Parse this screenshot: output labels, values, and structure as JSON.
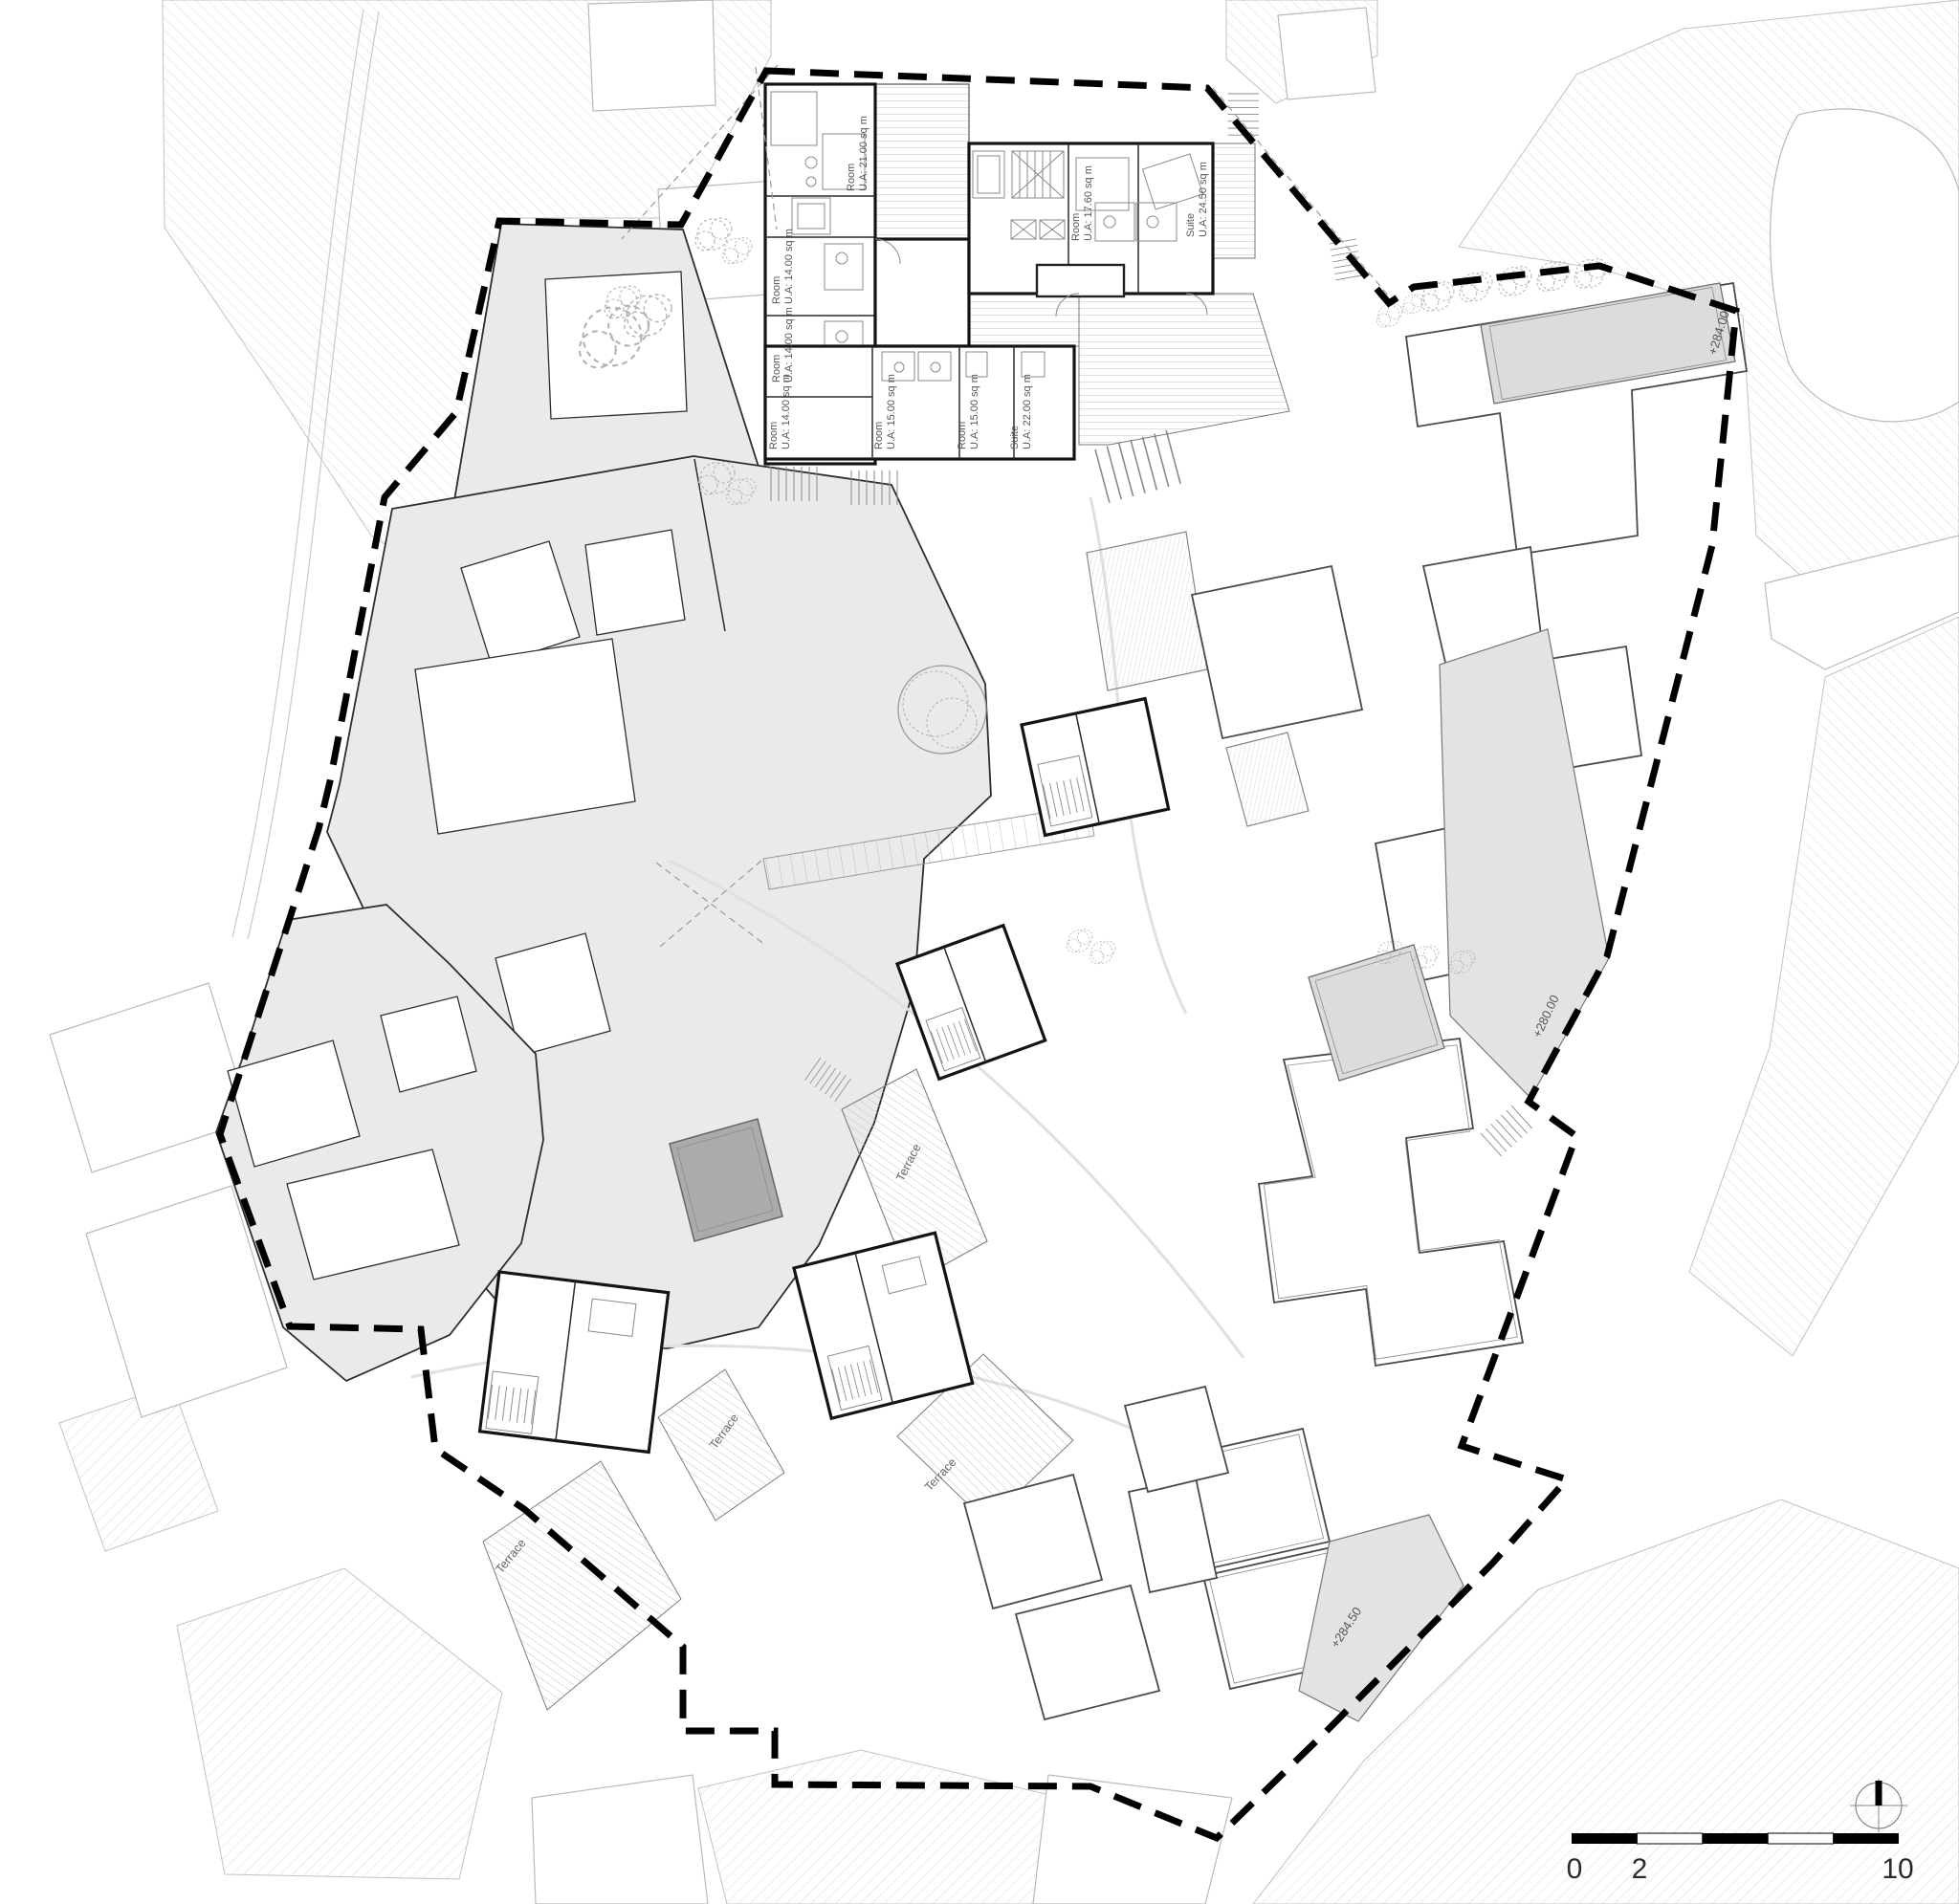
{
  "rooms": [
    {
      "name": "Room",
      "area": "U.A: 21.00 sq m"
    },
    {
      "name": "Room",
      "area": "U.A: 14.00 sq m"
    },
    {
      "name": "Room",
      "area": "U.A: 14.00 sq m"
    },
    {
      "name": "Room",
      "area": "U.A: 14.00 sq m"
    },
    {
      "name": "Room",
      "area": "U.A: 15.00 sq m"
    },
    {
      "name": "Room",
      "area": "U.A: 15.00 sq m"
    },
    {
      "name": "Suite",
      "area": "U.A: 22.00 sq m"
    },
    {
      "name": "Room",
      "area": "U.A: 17.60 sq m"
    },
    {
      "name": "Suite",
      "area": "U.A: 24.50 sq m"
    }
  ],
  "terraces": [
    "Terrace",
    "Terrace",
    "Terrace",
    "Terrace"
  ],
  "elevations": [
    "+284.00",
    "+280.00",
    "+284.50"
  ],
  "scale_bar": {
    "tick_0": "0",
    "tick_2": "2",
    "tick_10": "10"
  }
}
